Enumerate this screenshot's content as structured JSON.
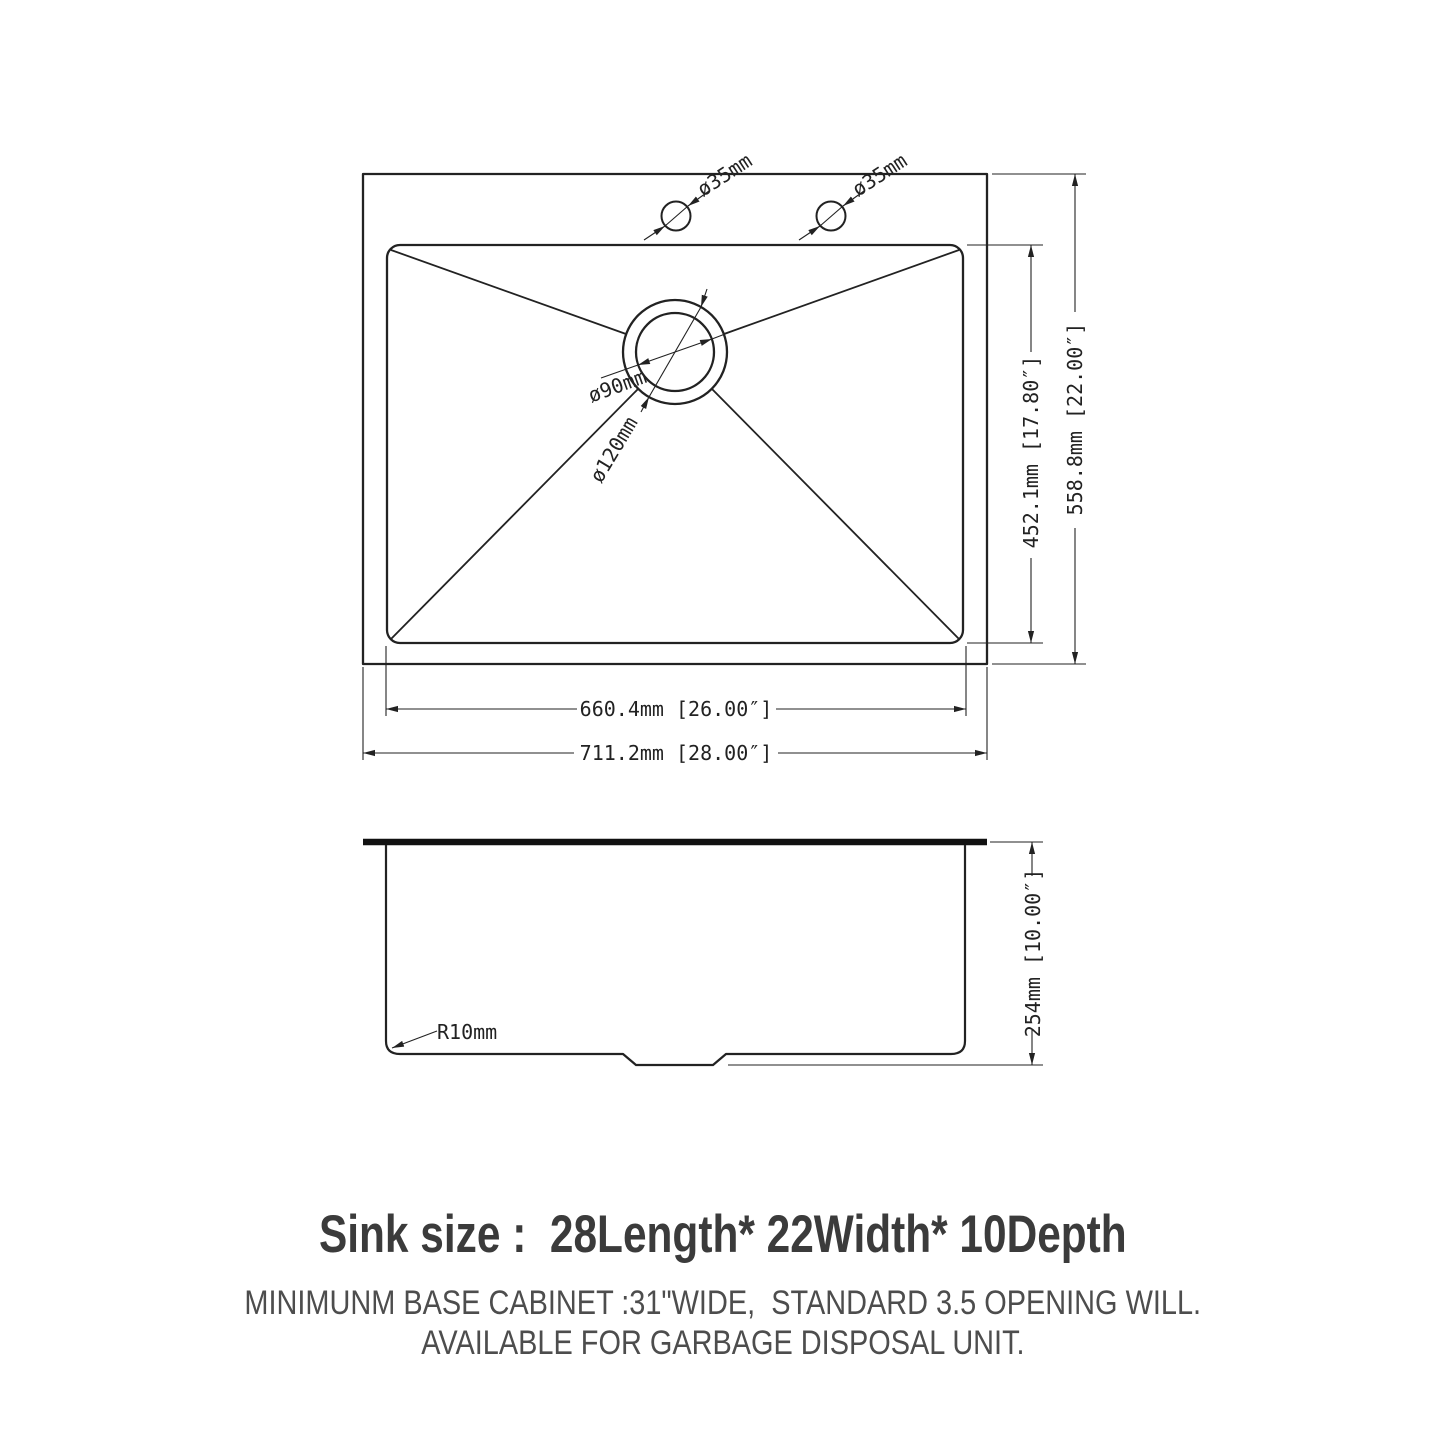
{
  "colors": {
    "background": "#ffffff",
    "line": "#222222",
    "title_text": "#3b3b3b",
    "subtitle_text": "#4d4d4d"
  },
  "top_view": {
    "hole1_label": "ø35mm",
    "hole2_label": "ø35mm",
    "drain_inner_label": "ø90mm",
    "drain_outer_label": "ø120mm",
    "bowl_height_label": "452.1mm [17.80″]",
    "overall_height_label": "558.8mm [22.00″]",
    "bowl_width_label": "660.4mm [26.00″]",
    "overall_width_label": "711.2mm [28.00″]"
  },
  "side_view": {
    "corner_radius_label": "R10mm",
    "depth_label": "254mm [10.00″]"
  },
  "captions": {
    "title": "Sink size :  28Length* 22Width* 10Depth",
    "line1": "MINIMUNM BASE CABINET :31\"WIDE,  STANDARD 3.5 OPENING WILL.",
    "line2": "AVAILABLE FOR GARBAGE DISPOSAL UNIT."
  }
}
